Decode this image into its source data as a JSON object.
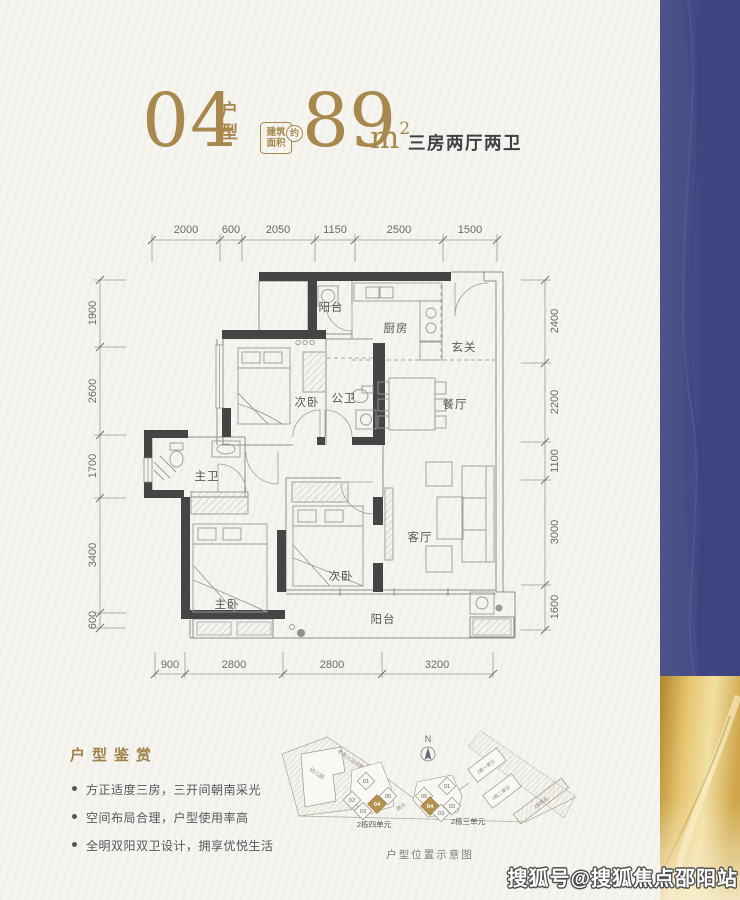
{
  "header": {
    "unit_number": "04",
    "unit_type_label_1": "户",
    "unit_type_label_2": "型",
    "area_badge": {
      "line1": "建筑",
      "line2": "面积",
      "approx": "约"
    },
    "area_value": "89",
    "area_unit": "m",
    "area_exponent": "2",
    "layout_summary": "三房两厅两卫"
  },
  "floorplan": {
    "room_labels": {
      "balcony_top": "阳台",
      "kitchen": "厨房",
      "foyer": "玄关",
      "bedroom2": "次卧",
      "public_bath": "公卫",
      "dining": "餐厅",
      "master_bath": "主卫",
      "master_bedroom": "主卧",
      "bedroom3": "次卧",
      "living": "客厅",
      "balcony_bottom": "阳台"
    },
    "dims_top": [
      "2000",
      "600",
      "2050",
      "1150",
      "2500",
      "1500"
    ],
    "dims_left": [
      "1900",
      "2600",
      "1700",
      "3400",
      "600"
    ],
    "dims_right": [
      "2400",
      "2200",
      "1100",
      "3000",
      "1600"
    ],
    "dims_bottom": [
      "900",
      "2800",
      "2800",
      "3200"
    ]
  },
  "appreciation": {
    "title": "户型鉴赏",
    "bullets": [
      "方正适度三房，三开间朝南采光",
      "空间布局合理，户型使用率高",
      "全明双阳双卫设计，拥享优悦生活"
    ]
  },
  "siteplan": {
    "compass_label": "N",
    "caption": "户型位置示意图",
    "left_cluster_label": "2栋四单元",
    "right_cluster_label": "2栋三单元",
    "left_units": [
      "01",
      "05",
      "02",
      "04",
      "03"
    ],
    "right_units": [
      "05",
      "01",
      "04",
      "02",
      "03"
    ],
    "highlight_unit": "04",
    "area_labels": {
      "business": "商业",
      "kindergarten": "幼儿园",
      "daycare": "老年人日间照料中心",
      "bldg_unit1": "2栋一单元",
      "bldg_unit2": "2栋二单元",
      "bldg_business": "1栋商业"
    }
  },
  "watermark": "搜狐号@搜狐焦点邵阳站",
  "colors": {
    "gold_accent": "#a7894e",
    "dark_text": "#3d4045",
    "blue_band": "#464a86",
    "gold_band": "#e6c570",
    "wall": "#454545",
    "paper": "#f6f4ef"
  }
}
